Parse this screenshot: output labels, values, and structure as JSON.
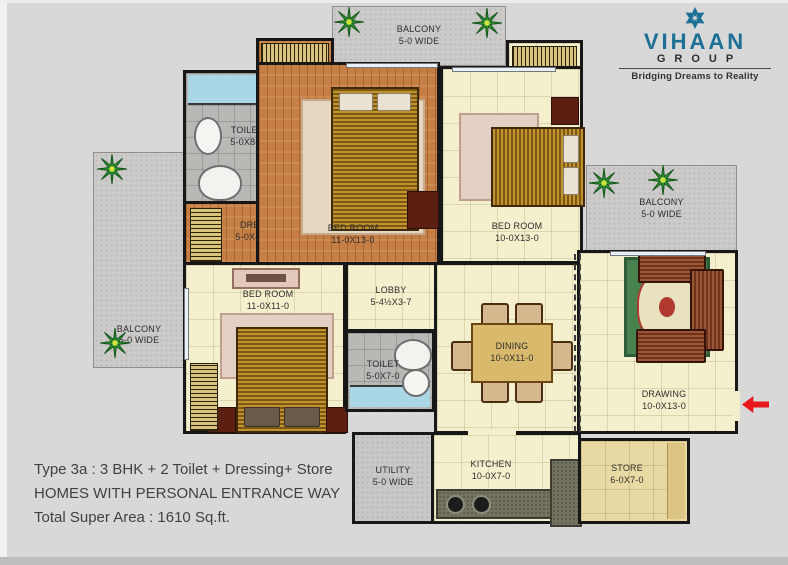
{
  "brand": {
    "name": "VIHAAN",
    "group": "GROUP",
    "tagline": "Bridging Dreams to Reality"
  },
  "footer": {
    "line1": "Type 3a : 3 BHK + 2 Toilet + Dressing+ Store",
    "line2": "HOMES WITH PERSONAL ENTRANCE WAY",
    "line3": "Total Super Area : 1610 Sq.ft."
  },
  "rooms": {
    "balcony_top": {
      "label": "BALCONY",
      "size": "5-0 WIDE"
    },
    "balcony_left": {
      "label": "BALCONY",
      "size": "5-0 WIDE"
    },
    "balcony_right": {
      "label": "BALCONY",
      "size": "5-0 WIDE"
    },
    "toilet_1": {
      "label": "TOILET",
      "size": "5-0X8-0"
    },
    "dress": {
      "label": "DRESS",
      "size": "5-0X4-7½"
    },
    "bedroom_1": {
      "label": "BED ROOM",
      "size": "11-0X13-0"
    },
    "bedroom_2": {
      "label": "BED ROOM",
      "size": "10-0X13-0"
    },
    "bedroom_3": {
      "label": "BED ROOM",
      "size": "11-0X11-0"
    },
    "lobby": {
      "label": "LOBBY",
      "size": "5-4½X3-7"
    },
    "toilet_2": {
      "label": "TOILET",
      "size": "5-0X7-0"
    },
    "dining": {
      "label": "DINING",
      "size": "10-0X11-0"
    },
    "drawing": {
      "label": "DRAWING",
      "size": "10-0X13-0"
    },
    "utility": {
      "label": "UTILITY",
      "size": "5-0 WIDE"
    },
    "kitchen": {
      "label": "KITCHEN",
      "size": "10-0X7-0"
    },
    "store": {
      "label": "STORE",
      "size": "6-0X7-0"
    }
  },
  "colors": {
    "brand_teal": "#1c7095",
    "entrance_arrow_red": "#e8191c",
    "wall_black": "#171717",
    "floor_cream": "#f4efcd",
    "floor_wood": "#c57e44",
    "balcony_gray": "#cccbc9"
  }
}
